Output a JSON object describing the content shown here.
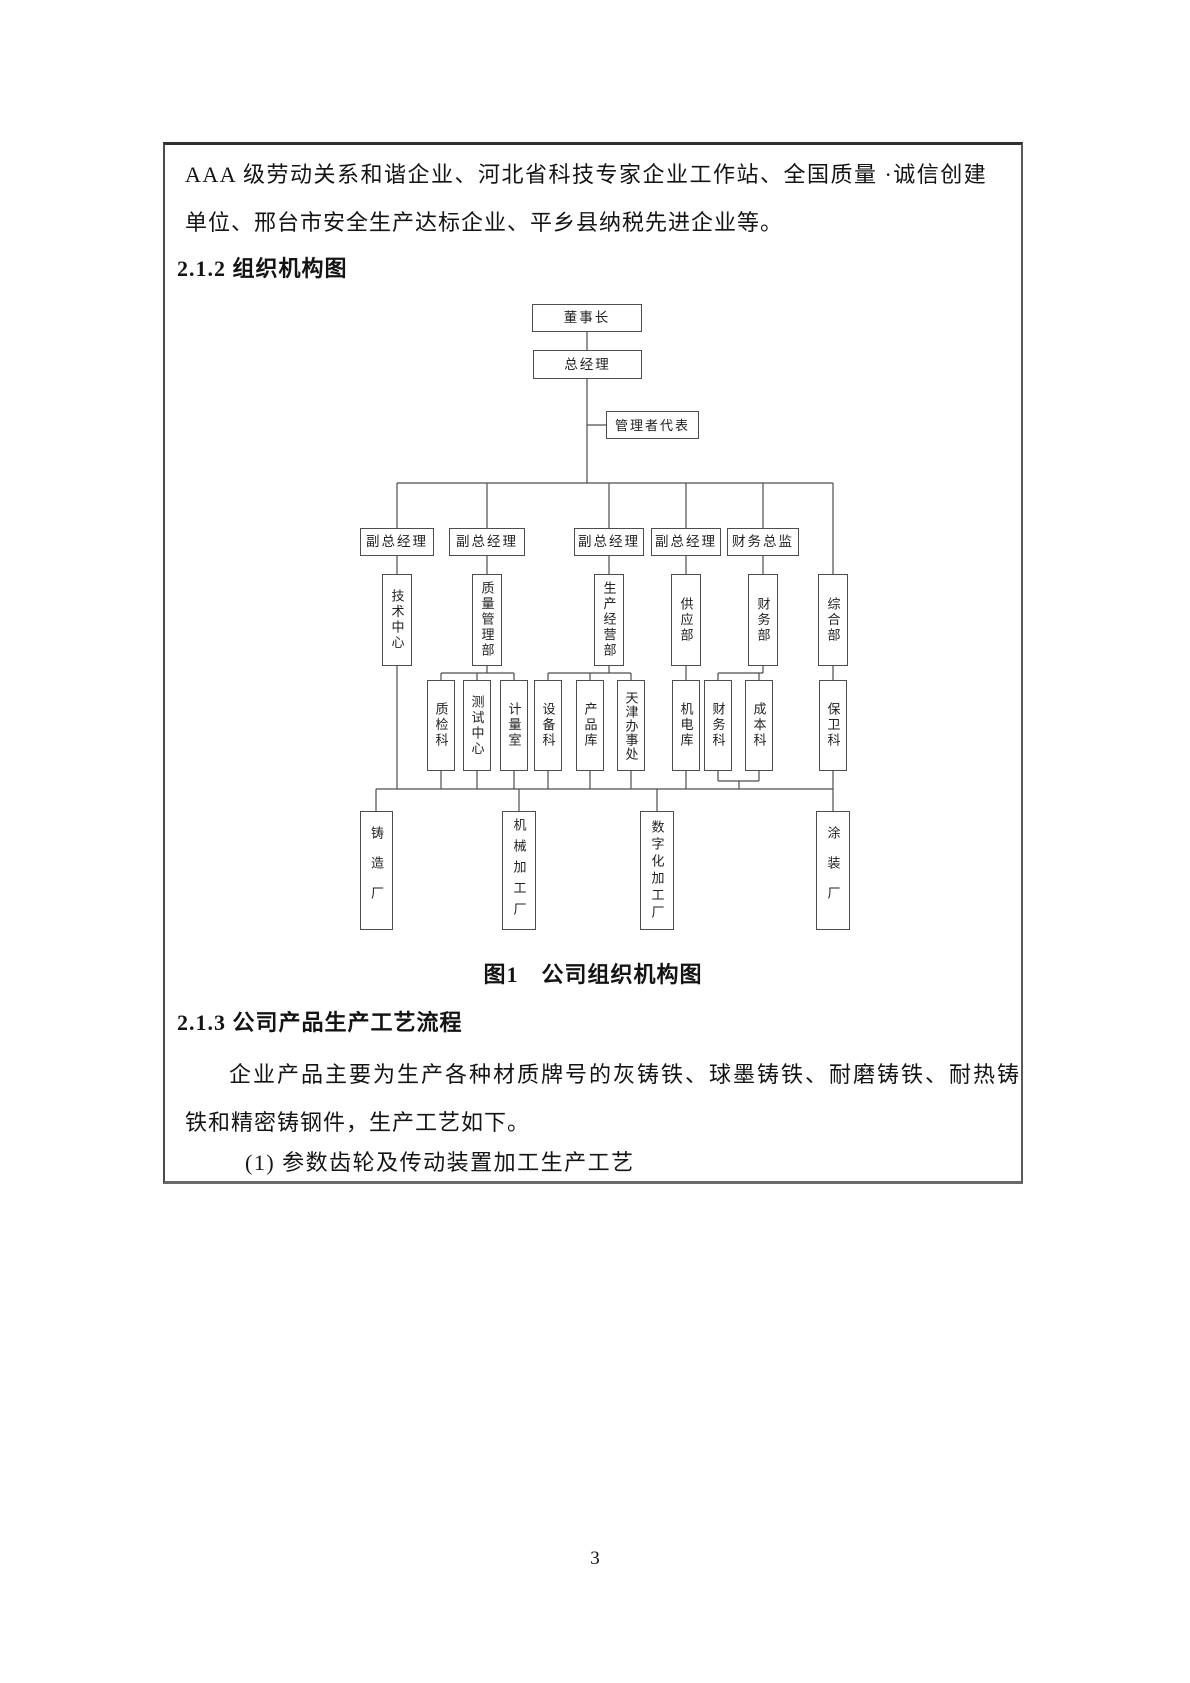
{
  "document": {
    "para1_line1": "AAA 级劳动关系和谐企业、河北省科技专家企业工作站、全国质量 ·诚信创建",
    "para1_line2": "单位、邢台市安全生产达标企业、平乡县纳税先进企业等。",
    "heading_212": "2.1.2 组织机构图",
    "figure_caption": "图1　公司组织机构图",
    "heading_213": "2.1.3 公司产品生产工艺流程",
    "para2_line1": "企业产品主要为生产各种材质牌号的灰铸铁、球墨铸铁、耐磨铸铁、耐热铸",
    "para2_line2": "铁和精密铸钢件，生产工艺如下。",
    "list_item_1": "(1)  参数齿轮及传动装置加工生产工艺",
    "page_number": "3"
  },
  "org_chart": {
    "type": "org-tree",
    "title": "图1　公司组织机构图",
    "nodes": {
      "chairman": "董事长",
      "general_manager": "总经理",
      "management_rep": "管理者代表",
      "vgm1": "副总经理",
      "vgm2": "副总经理",
      "vgm3": "副总经理",
      "vgm4": "副总经理",
      "cfo": "财务总监",
      "tech_center": "技术中心",
      "quality_dept": "质量管理部",
      "production_dept": "生产经营部",
      "supply_dept": "供应部",
      "finance_dept": "财务部",
      "general_dept": "综合部",
      "inspection_sec": "质检科",
      "test_center": "测试中心",
      "metrology_room": "计量室",
      "equipment_sec": "设备科",
      "product_store": "产品库",
      "tianjin_office": "天津办事处",
      "electromech_store": "机电库",
      "finance_sec": "财务科",
      "cost_sec": "成本科",
      "security_sec": "保卫科",
      "foundry_plant": "铸造厂",
      "machining_plant": "机械加工厂",
      "digital_plant": "数字化加工厂",
      "painting_plant": "涂装厂"
    },
    "hierarchy": "董事长→总经理(→管理者代表)→[副总经理×4,财务总监]→[技术中心,质量管理部(质检科,测试中心,计量室),生产经营部(设备科,产品库,天津办事处),供应部(机电库),财务部(财务科,成本科),综合部(保卫科)]→[铸造厂,机械加工厂,数字化加工厂,涂装厂]"
  }
}
